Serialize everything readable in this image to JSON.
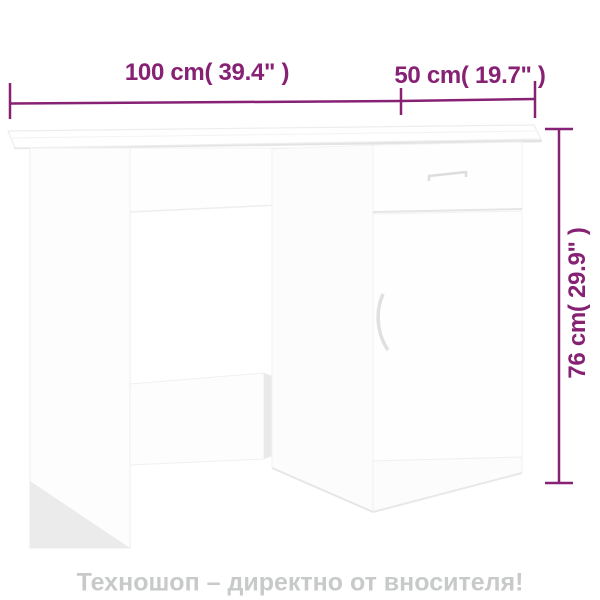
{
  "theme": {
    "background": "#ffffff",
    "accent": "#862174",
    "watermark": "#c8caca"
  },
  "product": {
    "type": "desk with drawer and cabinet door",
    "color": "white",
    "width_cm": 100,
    "width_in": 39.4,
    "depth_cm": 50,
    "depth_in": 19.7,
    "height_cm": 76,
    "height_in": 29.9
  },
  "labels": {
    "width": "100 cm( 39.4\" )",
    "depth": "50 cm( 19.7\" )",
    "height": "76 cm( 29.9\" )"
  },
  "footer": {
    "text": "Техношоп – директно от вносителя!"
  }
}
